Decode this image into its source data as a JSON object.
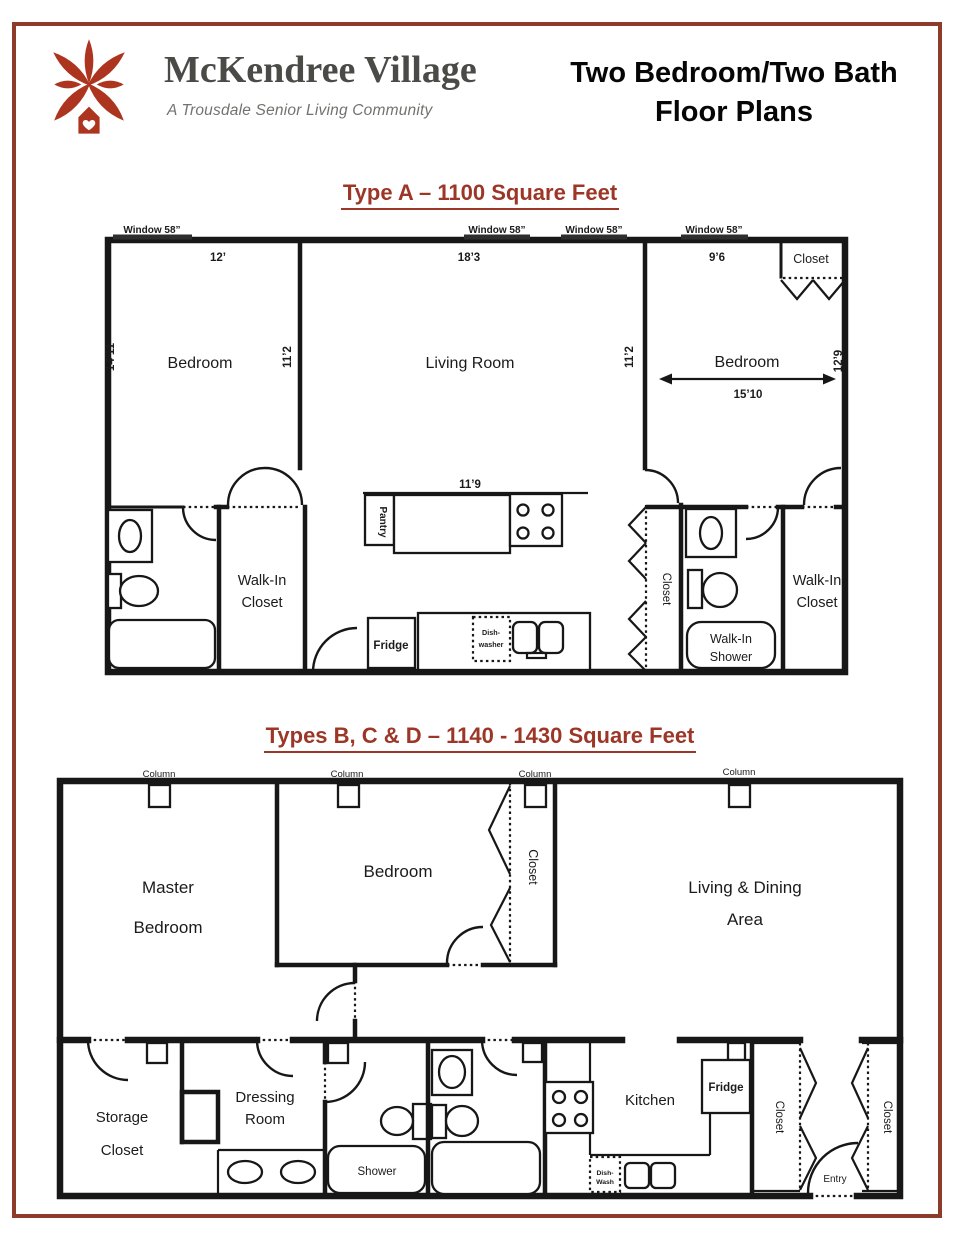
{
  "header": {
    "brand": "McKendree Village",
    "tagline": "A Trousdale Senior Living Community",
    "title_line1": "Two Bedroom/Two Bath",
    "title_line2": "Floor Plans"
  },
  "colors": {
    "accent": "#9c3727",
    "frame": "#8d3c2c",
    "logo": "#ad3520",
    "ink": "#171717"
  },
  "icons": {
    "logo_flower": "mckendree-flower-logo",
    "heart": "heart-icon"
  },
  "plan_a": {
    "title": "Type A – 1100 Square Feet",
    "window_label": "Window 58”",
    "dims": {
      "bed_left_w": "12’",
      "living_w": "18’3",
      "bed_right_top": "9’6",
      "bed_left_d": "14’11",
      "bed_left_inner": "11’2",
      "living_inner": "11’2",
      "bed_right_d": "12’9",
      "bed_right_w": "15’10",
      "counter_w": "11’9"
    },
    "rooms": {
      "bedroom_left": "Bedroom",
      "living": "Living Room",
      "bedroom_right": "Bedroom",
      "closet": "Closet",
      "walk_in": "Walk-In",
      "closet_word": "Closet",
      "shower_word": "Shower",
      "pantry": "Pantry",
      "fridge": "Fridge",
      "dish_line1": "Dish-",
      "dish_line2": "washer"
    }
  },
  "plan_b": {
    "title": "Types B, C & D – 1140 - 1430 Square Feet",
    "column_label": "Column",
    "rooms": {
      "master_line1": "Master",
      "master_line2": "Bedroom",
      "bedroom": "Bedroom",
      "closet": "Closet",
      "living_line1": "Living & Dining",
      "living_line2": "Area",
      "storage_line1": "Storage",
      "storage_line2": "Closet",
      "dressing_line1": "Dressing",
      "dressing_line2": "Room",
      "shower": "Shower",
      "kitchen": "Kitchen",
      "fridge": "Fridge",
      "dish_line1": "Dish-",
      "dish_line2": "Wash",
      "entry": "Entry"
    }
  }
}
